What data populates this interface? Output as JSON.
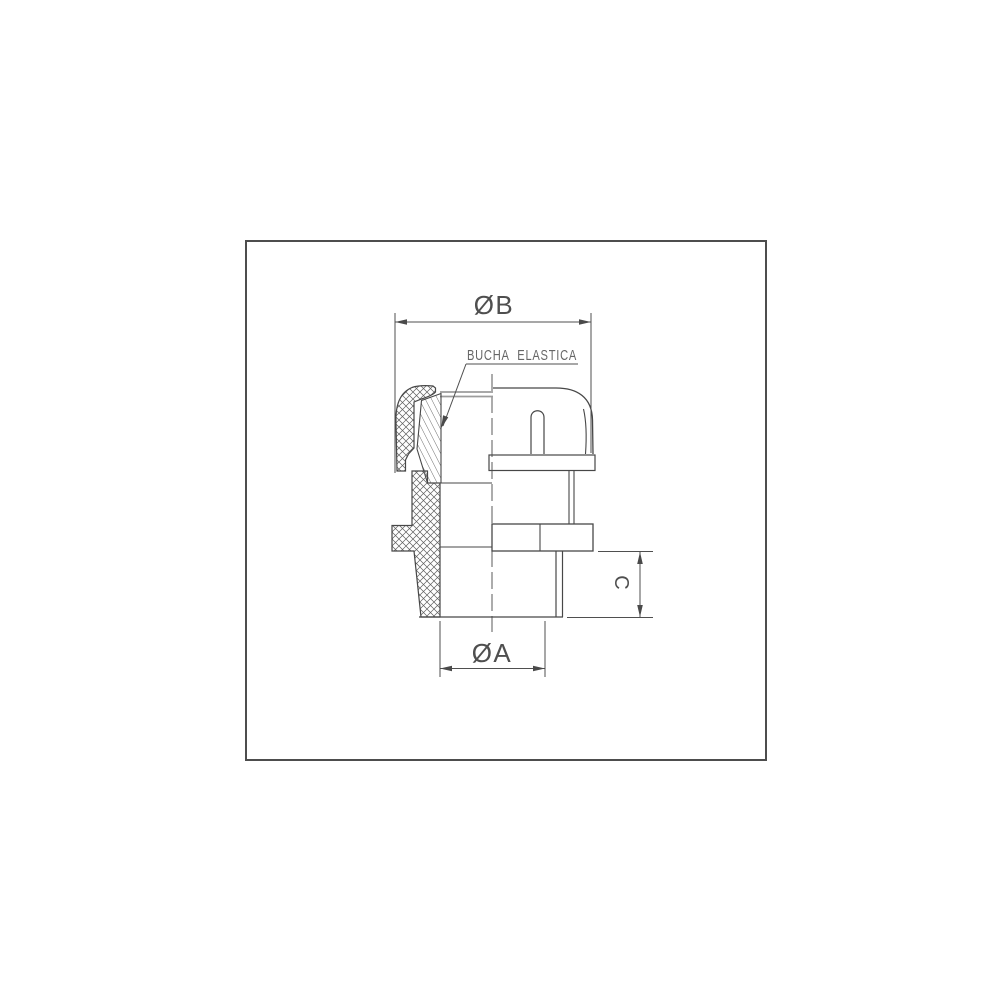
{
  "labels": {
    "dim_diameter_b": "ØB",
    "dim_diameter_a": "ØA",
    "dim_height_c": "C",
    "callout_bushing": "BUCHA ELASTICA"
  },
  "colors": {
    "background": "#ffffff",
    "frame_border": "#4d4d4d",
    "drawing_line": "#474747",
    "dimension_line": "#4f4f4f",
    "label_text": "#4f4f4f",
    "callout_text": "#666666",
    "hatch_line": "#5f5f5f",
    "soft_edge": "#9c9c9c"
  }
}
